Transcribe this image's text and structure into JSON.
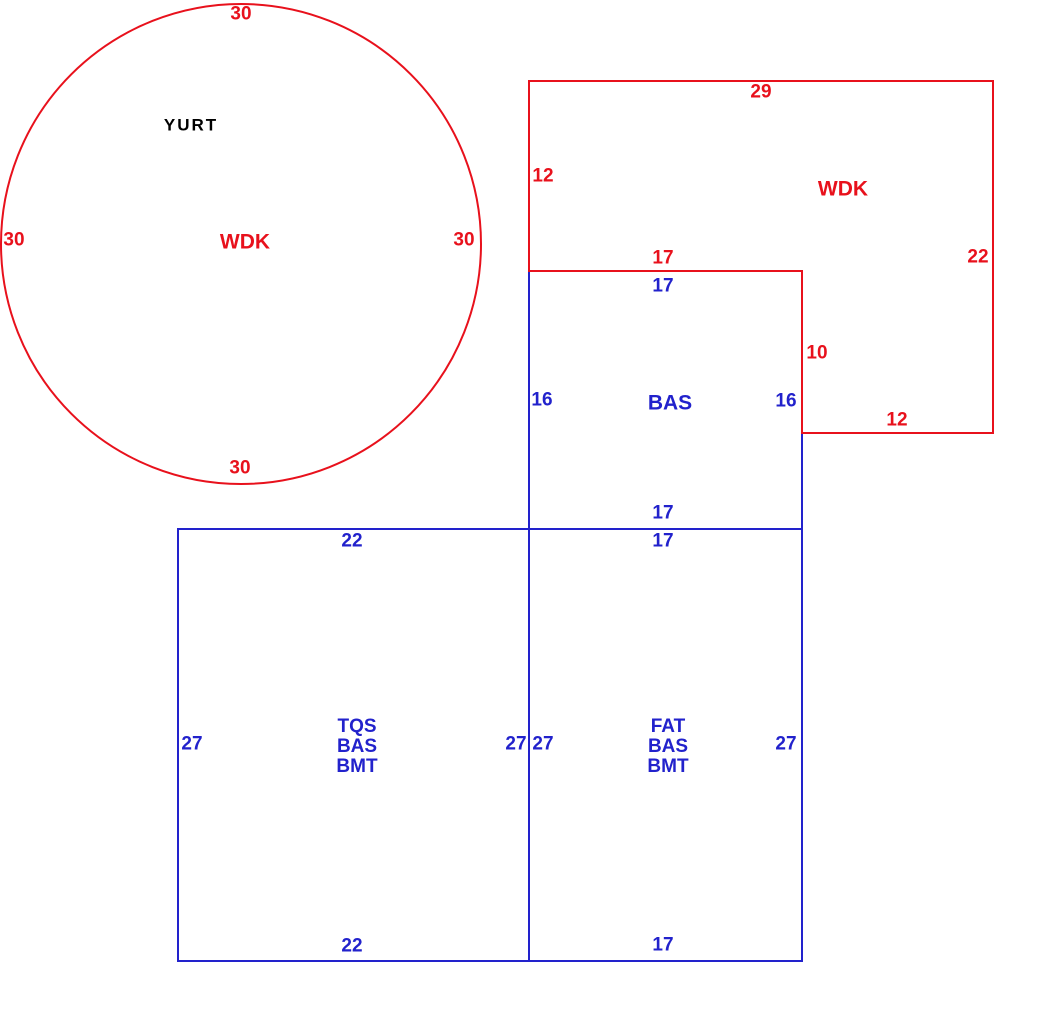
{
  "canvas": {
    "width": "1045",
    "height": "1013"
  },
  "colors": {
    "red": "#e8111c",
    "blue": "#2222cc",
    "black": "#000000",
    "background": "#ffffff"
  },
  "sketch": {
    "yurt": {
      "building_label": "YURT",
      "area_label": "WDK",
      "dim_top": "30",
      "dim_left": "30",
      "dim_right": "30",
      "dim_bottom": "30"
    },
    "wdk_deck": {
      "area_label": "WDK",
      "dim_top": "29",
      "dim_left": "12",
      "dim_right": "22",
      "dim_step_bottom": "17",
      "dim_step_right": "10",
      "dim_bottom": "12"
    },
    "bas": {
      "area_label": "BAS",
      "dim_top": "17",
      "dim_left": "16",
      "dim_right": "16",
      "dim_bottom": "17"
    },
    "tqs": {
      "area_labels": [
        "TQS",
        "BAS",
        "BMT"
      ],
      "dim_top": "22",
      "dim_left": "27",
      "dim_right": "27",
      "dim_bottom": "22"
    },
    "fat": {
      "area_labels": [
        "FAT",
        "BAS",
        "BMT"
      ],
      "dim_top": "17",
      "dim_left": "27",
      "dim_right": "27",
      "dim_bottom": "17"
    }
  }
}
